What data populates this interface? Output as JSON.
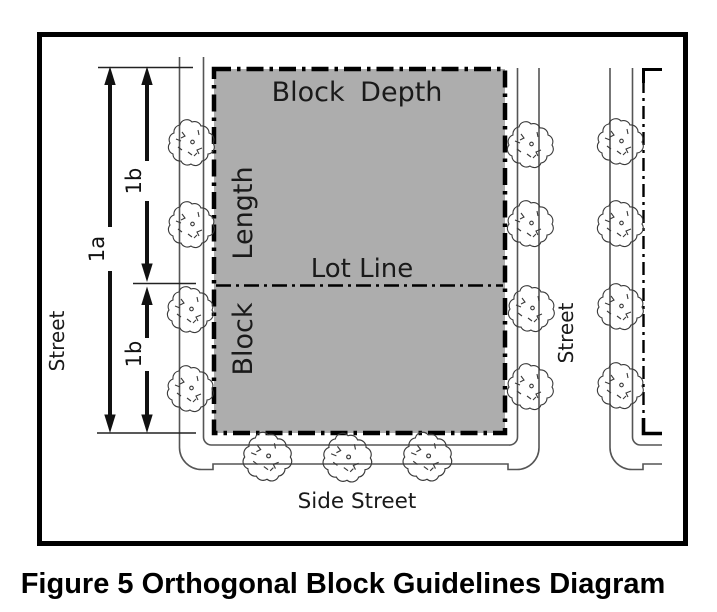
{
  "figure": {
    "caption": "Figure 5 Orthogonal Block Guidelines Diagram",
    "labels": {
      "block_depth": "Block Depth",
      "length": "Length",
      "lot_line": "Lot Line",
      "block": "Block",
      "street_left": "Street",
      "street_right": "Street",
      "side_street": "Side Street",
      "dim_overall": "1a",
      "dim_upper": "1b",
      "dim_lower": "1b"
    },
    "colors": {
      "block_fill": "#ADADAD",
      "border": "#000000",
      "street_line": "#555555",
      "tree_stroke": "#3A3A3A",
      "text": "#1A1A1A"
    }
  }
}
